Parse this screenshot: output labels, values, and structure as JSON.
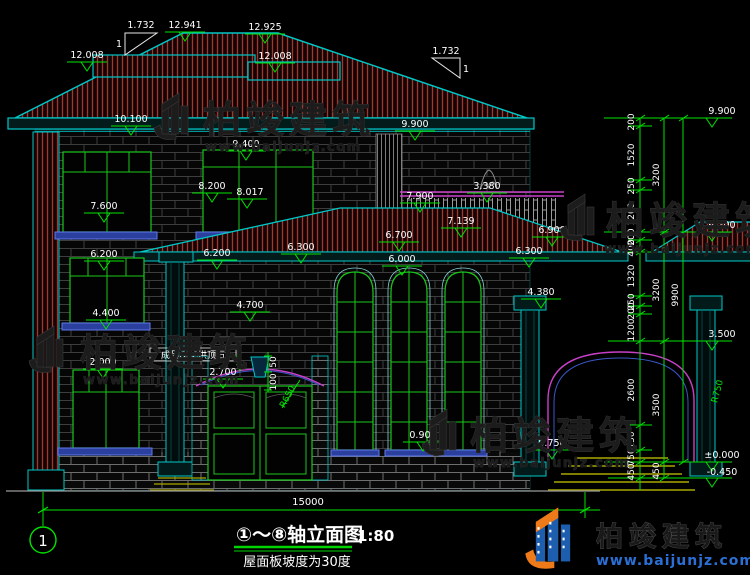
{
  "title": {
    "main": "①～⑧轴立面图",
    "scale": "1:80",
    "note": "屋面板坡度为30度"
  },
  "axis": {
    "no1": "1"
  },
  "overall": {
    "width_dim": "15000"
  },
  "slope": {
    "run": "1.732",
    "rise": "1"
  },
  "callouts": {
    "grc": "成品GRC拱顶石",
    "d50": "50",
    "d100": "100",
    "r_left": "R650",
    "r_right": "R750"
  },
  "marks": [
    "12.008",
    "12.941",
    "12.925",
    "12.008",
    "10.100",
    "9.900",
    "9.400",
    "8.200",
    "8.017",
    "7.600",
    "7.900",
    "3.380",
    "7.139",
    "6.700",
    "6.000",
    "6.900",
    "6.300",
    "6.200",
    "6.200",
    "6.300",
    "4.700",
    "4.400",
    "4.380",
    "2.700",
    "2.000",
    "0.900",
    "0.750"
  ],
  "right_levels": [
    "9.900",
    "6.700",
    "3.500",
    "±0.000",
    "-0.450"
  ],
  "chain1": [
    "200",
    "1520",
    "250",
    "1200",
    "200",
    "400",
    "1320",
    "250",
    "200",
    "1200",
    "2600",
    "150",
    "750",
    "450"
  ],
  "chain2": [
    "3200",
    "3200",
    "3500",
    "450"
  ],
  "chain3": [
    "9900"
  ],
  "watermark": {
    "name": "柏竣建筑",
    "url": "www.baijunjz.com"
  },
  "brand": {
    "name": "柏竣建筑",
    "url": "www.baijunjz.com"
  },
  "colors": {
    "background": "#000000",
    "dimension_green": "#00e400",
    "outline_teal": "#00c8c8",
    "roof_hatch_red": "#9a3a30",
    "window_green": "#1ac81a",
    "sill_blue": "#4a66d8",
    "rail_magenta": "#c840c8",
    "step_yellow": "#a8a800",
    "text_white": "#ffffff",
    "brand_blue": "#2b6fd4",
    "brand_orange": "#ee7a1a",
    "watermark_gray": "#1c1c1c"
  }
}
